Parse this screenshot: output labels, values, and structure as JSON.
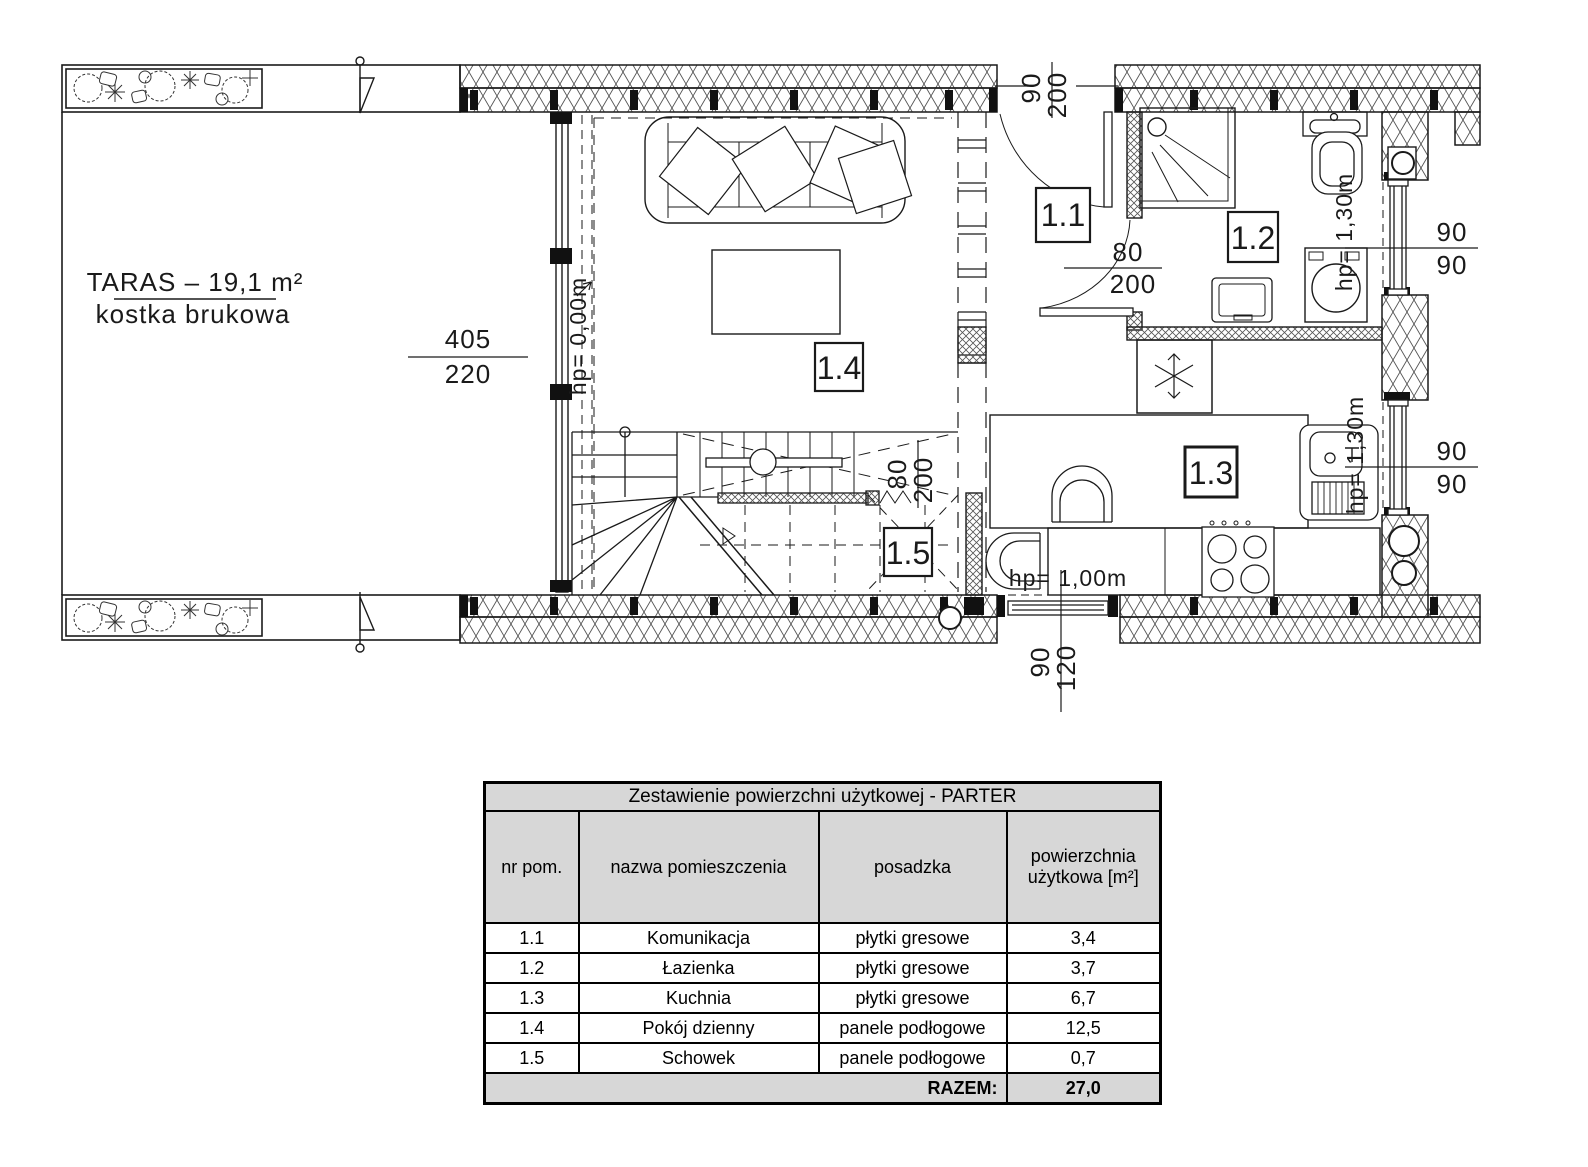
{
  "plan": {
    "terrace": {
      "title": "TARAS – 19,1 m²",
      "subtitle": "kostka brukowa"
    },
    "rooms": [
      {
        "label": "1.1"
      },
      {
        "label": "1.2"
      },
      {
        "label": "1.3"
      },
      {
        "label": "1.4"
      },
      {
        "label": "1.5"
      }
    ],
    "dims": {
      "terrace_window": {
        "num": "405",
        "den": "220"
      },
      "entrance": {
        "num": "90",
        "den": "200"
      },
      "bath_door": {
        "num": "80",
        "den": "200"
      },
      "stairs": {
        "num": "80",
        "den": "200"
      },
      "bath_window": {
        "num": "90",
        "den": "90"
      },
      "kitchen_window_side": {
        "num": "90",
        "den": "90"
      },
      "kitchen_window_bottom": {
        "num": "90",
        "den": "120"
      }
    },
    "levels": {
      "living": "hp= 0,00m",
      "bath_window": "hp= 1,30m",
      "kitchen_side_window": "hp= 1,30m",
      "kitchen_bottom_window": "hp= 1,00m"
    }
  },
  "table": {
    "title": "Zestawienie powierzchni użytkowej - PARTER",
    "headers": [
      "nr pom.",
      "nazwa pomieszczenia",
      "posadzka",
      "powierzchnia użytkowa [m²]"
    ],
    "rows": [
      {
        "no": "1.1",
        "name": "Komunikacja",
        "floor": "płytki gresowe",
        "area": "3,4"
      },
      {
        "no": "1.2",
        "name": "Łazienka",
        "floor": "płytki gresowe",
        "area": "3,7"
      },
      {
        "no": "1.3",
        "name": "Kuchnia",
        "floor": "płytki gresowe",
        "area": "6,7"
      },
      {
        "no": "1.4",
        "name": "Pokój dzienny",
        "floor": "panele podłogowe",
        "area": "12,5"
      },
      {
        "no": "1.5",
        "name": "Schowek",
        "floor": "panele podłogowe",
        "area": "0,7"
      }
    ],
    "total_label": "RAZEM:",
    "total_value": "27,0"
  },
  "colors": {
    "line": "#1a1a1a",
    "table_header_bg": "#d7d7d7"
  }
}
